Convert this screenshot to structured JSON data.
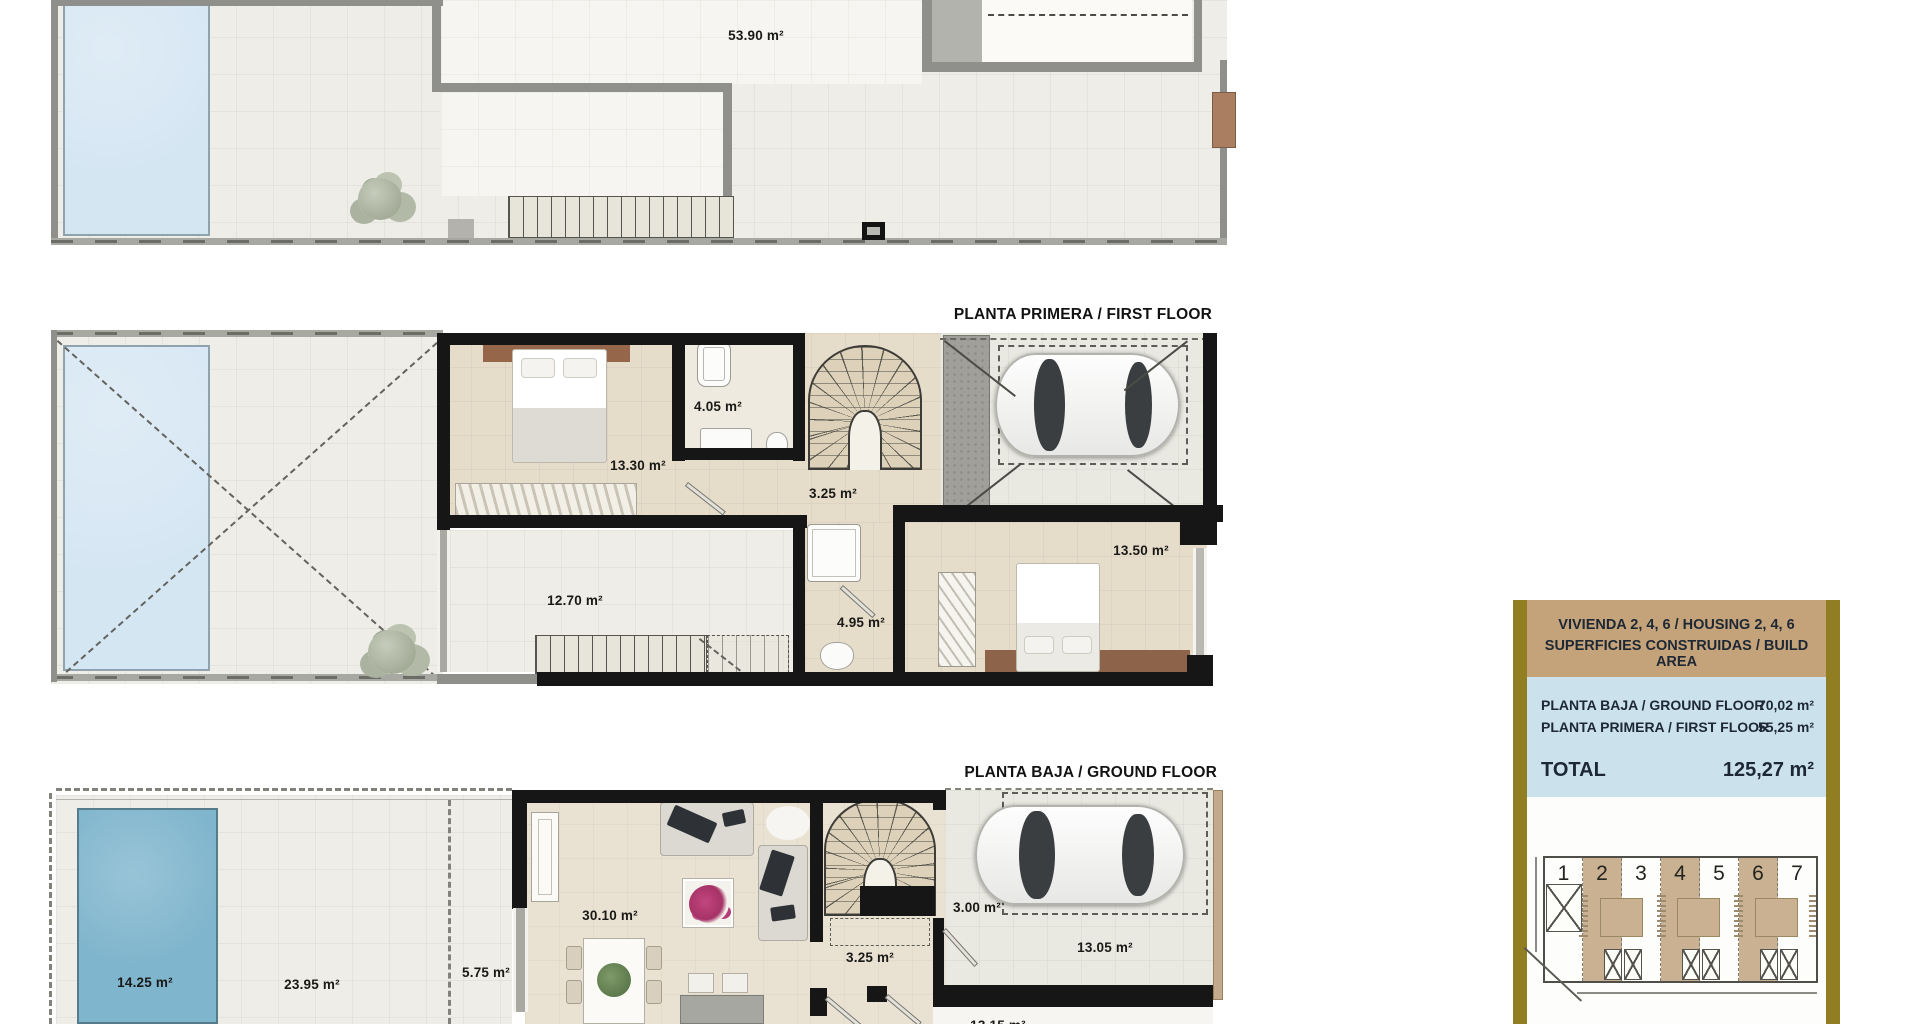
{
  "plans": {
    "roof": {
      "area_label": "53.90 m²"
    },
    "first_floor": {
      "title": "PLANTA PRIMERA / FIRST FLOOR",
      "areas": {
        "bedroom1": "13.30 m²",
        "bathroom1": "4.05 m²",
        "stair_hall": "3.25 m²",
        "terrace": "12.70 m²",
        "bathroom2": "4.95 m²",
        "bedroom2": "13.50 m²"
      }
    },
    "ground_floor": {
      "title": "PLANTA BAJA / GROUND FLOOR",
      "areas": {
        "pool": "14.25 m²",
        "garden": "23.95 m²",
        "porch": "5.75 m²",
        "living_room": "30.10 m²",
        "stair_hall": "3.25 m²",
        "entry": "3.00 m²",
        "carport": "13.05 m²",
        "bottom_room_partial": "13.15 m²"
      }
    }
  },
  "panel": {
    "title_line1": "VIVIENDA 2, 4, 6 / HOUSING 2, 4, 6",
    "title_line2": "SUPERFICIES CONSTRUIDAS / BUILD AREA",
    "rows": [
      {
        "label": "PLANTA BAJA / GROUND FLOOR",
        "value": "70,02 m²"
      },
      {
        "label": "PLANTA PRIMERA / FIRST FLOOR",
        "value": "55,25 m²"
      }
    ],
    "total_label": "TOTAL",
    "total_value": "125,27 m²",
    "site_plan": {
      "units": [
        "1",
        "2",
        "3",
        "4",
        "5",
        "6",
        "7"
      ],
      "highlighted_units": [
        "2",
        "4",
        "6"
      ]
    },
    "colors": {
      "frame_gold": "#917d22",
      "header_tan": "#c4a37b",
      "body_blue": "#cbe2ed",
      "text_navy": "#1d2834",
      "unit_highlight": "#c9b191"
    }
  }
}
